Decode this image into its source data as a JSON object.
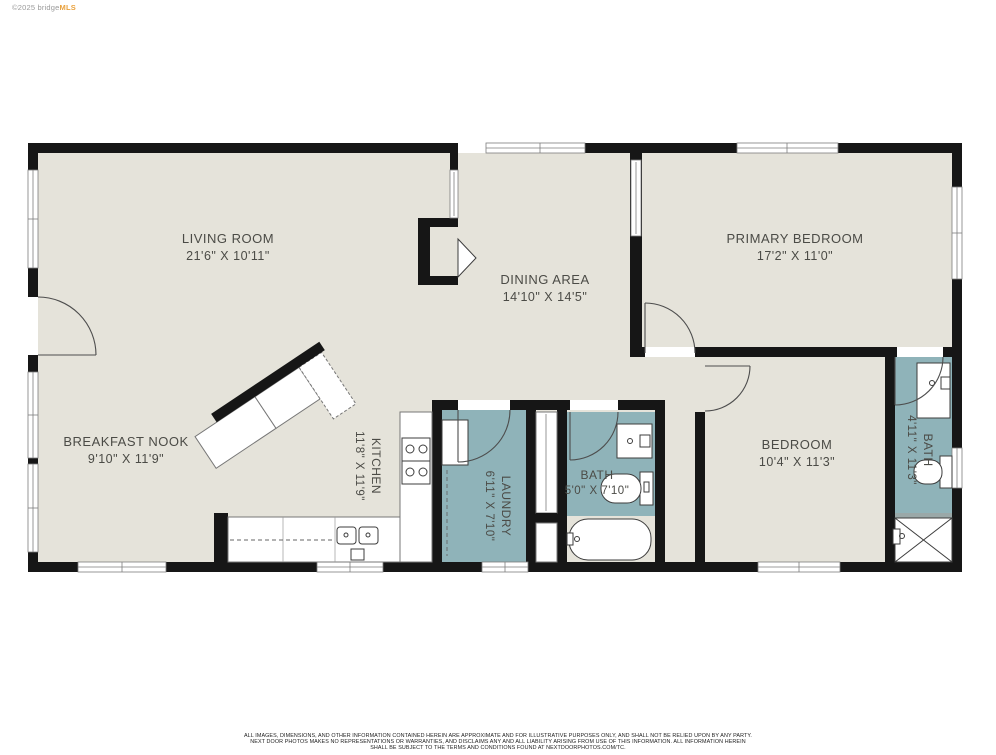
{
  "watermark": {
    "prefix": "©2025 bridge",
    "brand": "MLS"
  },
  "rooms": [
    {
      "id": "living-room",
      "name": "LIVING ROOM",
      "dims": "21'6\" X 10'11\""
    },
    {
      "id": "dining-area",
      "name": "DINING AREA",
      "dims": "14'10\" X 14'5\""
    },
    {
      "id": "primary-bedroom",
      "name": "PRIMARY BEDROOM",
      "dims": "17'2\" X 11'0\""
    },
    {
      "id": "breakfast-nook",
      "name": "BREAKFAST NOOK",
      "dims": "9'10\" X 11'9\""
    },
    {
      "id": "kitchen",
      "name": "KITCHEN",
      "dims": "11'8\" X 11'9\"",
      "rotated": true
    },
    {
      "id": "laundry",
      "name": "LAUNDRY",
      "dims": "6'11\" X 7'10\"",
      "rotated": true
    },
    {
      "id": "bath",
      "name": "BATH",
      "dims": "5'0\" X 7'10\""
    },
    {
      "id": "bedroom",
      "name": "BEDROOM",
      "dims": "10'4\" X 11'3\""
    },
    {
      "id": "bath-2",
      "name": "BATH",
      "dims": "4'11\" X 11'3\"",
      "rotated": true
    }
  ],
  "colors": {
    "floor": "#e5e3da",
    "wet_room": "#8fb3b9",
    "wall": "#161616",
    "label": "#4b4b46",
    "brand_orange": "#e9a13c"
  },
  "disclaimer": {
    "line1": "ALL IMAGES, DIMENSIONS, AND OTHER INFORMATION CONTAINED HEREIN ARE APPROXIMATE AND FOR ILLUSTRATIVE PURPOSES ONLY, AND SHALL NOT BE RELIED UPON BY ANY PARTY.",
    "line2": "NEXT DOOR PHOTOS MAKES NO REPRESENTATIONS OR WARRANTIES, AND DISCLAIMS ANY AND ALL LIABILITY ARISING FROM USE OF THIS INFORMATION. ALL INFORMATION HEREIN",
    "line3": "SHALL BE SUBJECT TO THE TERMS AND CONDITIONS FOUND AT NEXTDOORPHOTOS.COM/TC."
  }
}
